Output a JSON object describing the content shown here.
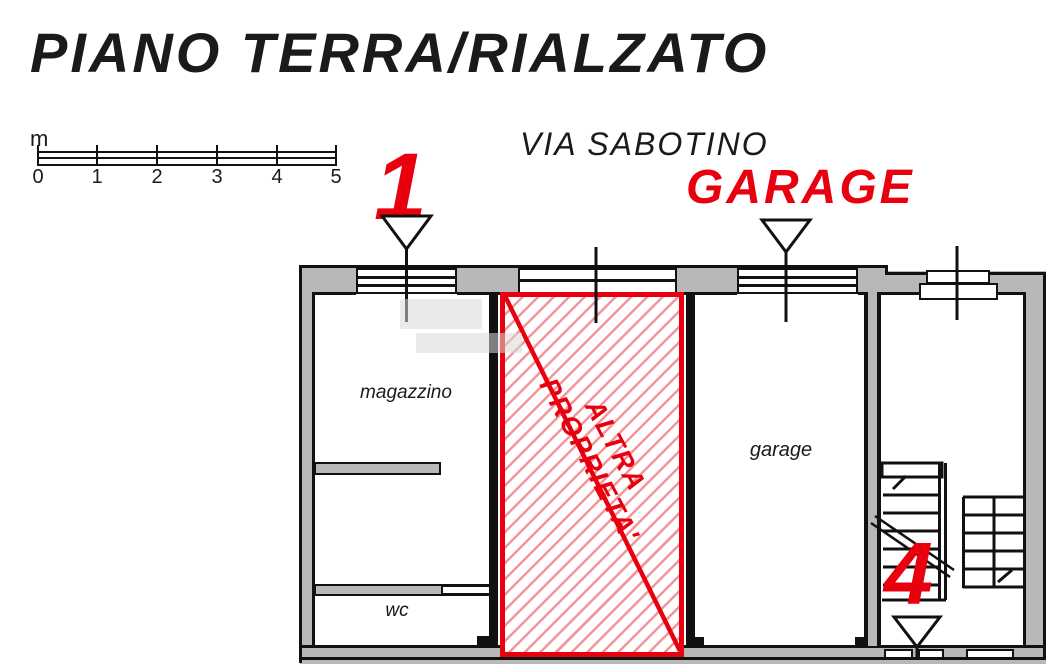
{
  "title": "PIANO TERRA/RIALZATO",
  "street_name": "VIA SABOTINO",
  "garage_banner": "GARAGE",
  "unit_markers": {
    "unit_1": "1",
    "unit_4": "4"
  },
  "rooms": {
    "magazzino": "magazzino",
    "wc": "wc",
    "garage": "garage"
  },
  "other_property": {
    "line1": "ALTRA",
    "line2": "PROPRIETA'"
  },
  "scale_bar": {
    "unit": "m",
    "tick_labels": [
      "0",
      "1",
      "2",
      "3",
      "4",
      "5"
    ]
  },
  "colors": {
    "accent_red": "#e8000f",
    "wall_gray": "#b8b8b8",
    "line_black": "#111111",
    "hatch_red_line": "rgba(232,0,15,0.42)",
    "watermark_gray": "#d9d9d9"
  }
}
